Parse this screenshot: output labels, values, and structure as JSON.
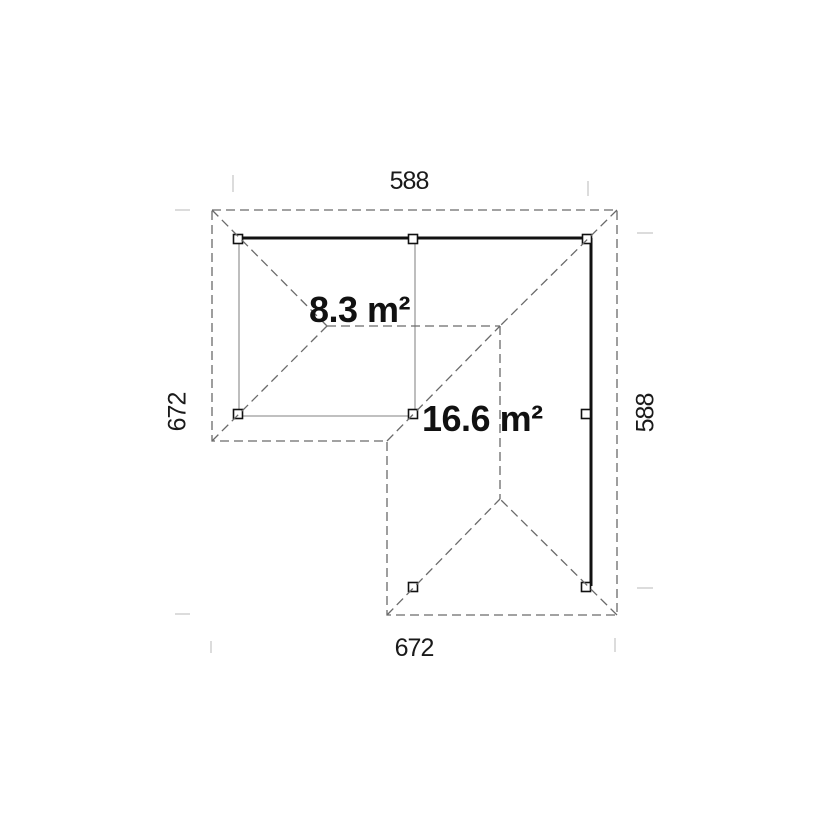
{
  "title": "L-shaped pavilion floor plan",
  "colors": {
    "background": "#ffffff",
    "heavy_line": "#111111",
    "light_line": "#9b9b9b",
    "dashed_line": "#6a6a6a",
    "witness_line": "#d4d4d4",
    "post_fill": "#ffffff",
    "post_stroke": "#111111",
    "label_text": "#1a1a1a"
  },
  "labels": {
    "dim_top": "588",
    "dim_bottom": "672",
    "dim_left": "672",
    "dim_right": "588",
    "area_small": "8.3 m²",
    "area_large": "16.6 m²"
  },
  "geometry": {
    "roof_outline_points": "212,210 617,210 617,615 387,615 387,441 212,441",
    "roof_lines": [
      [
        212,
        210,
        327,
        326
      ],
      [
        212,
        441,
        327,
        326
      ],
      [
        327,
        326,
        500,
        326
      ],
      [
        617,
        210,
        500,
        326
      ],
      [
        387,
        441,
        500,
        326
      ],
      [
        500,
        326,
        500,
        499
      ],
      [
        387,
        615,
        500,
        499
      ],
      [
        617,
        615,
        500,
        499
      ]
    ],
    "heavy_beams": [
      [
        236,
        238,
        592,
        238
      ],
      [
        591,
        238,
        591,
        586
      ]
    ],
    "light_beams": [
      [
        239,
        239,
        239,
        414
      ],
      [
        239,
        416,
        414,
        416
      ],
      [
        415,
        240,
        415,
        414
      ]
    ],
    "posts": [
      [
        238,
        239
      ],
      [
        413,
        239
      ],
      [
        587,
        239
      ],
      [
        238,
        414
      ],
      [
        413,
        414
      ],
      [
        586,
        414
      ],
      [
        413,
        587
      ],
      [
        586,
        587
      ]
    ],
    "post_size": 9,
    "witness_ticks": [
      [
        233,
        175,
        233,
        192
      ],
      [
        588,
        181,
        588,
        196
      ],
      [
        637,
        233,
        653,
        233
      ],
      [
        637,
        588,
        653,
        588
      ],
      [
        175,
        210,
        190,
        210
      ],
      [
        175,
        614,
        190,
        614
      ],
      [
        211,
        641,
        211,
        653
      ],
      [
        615,
        638,
        615,
        652
      ]
    ]
  }
}
